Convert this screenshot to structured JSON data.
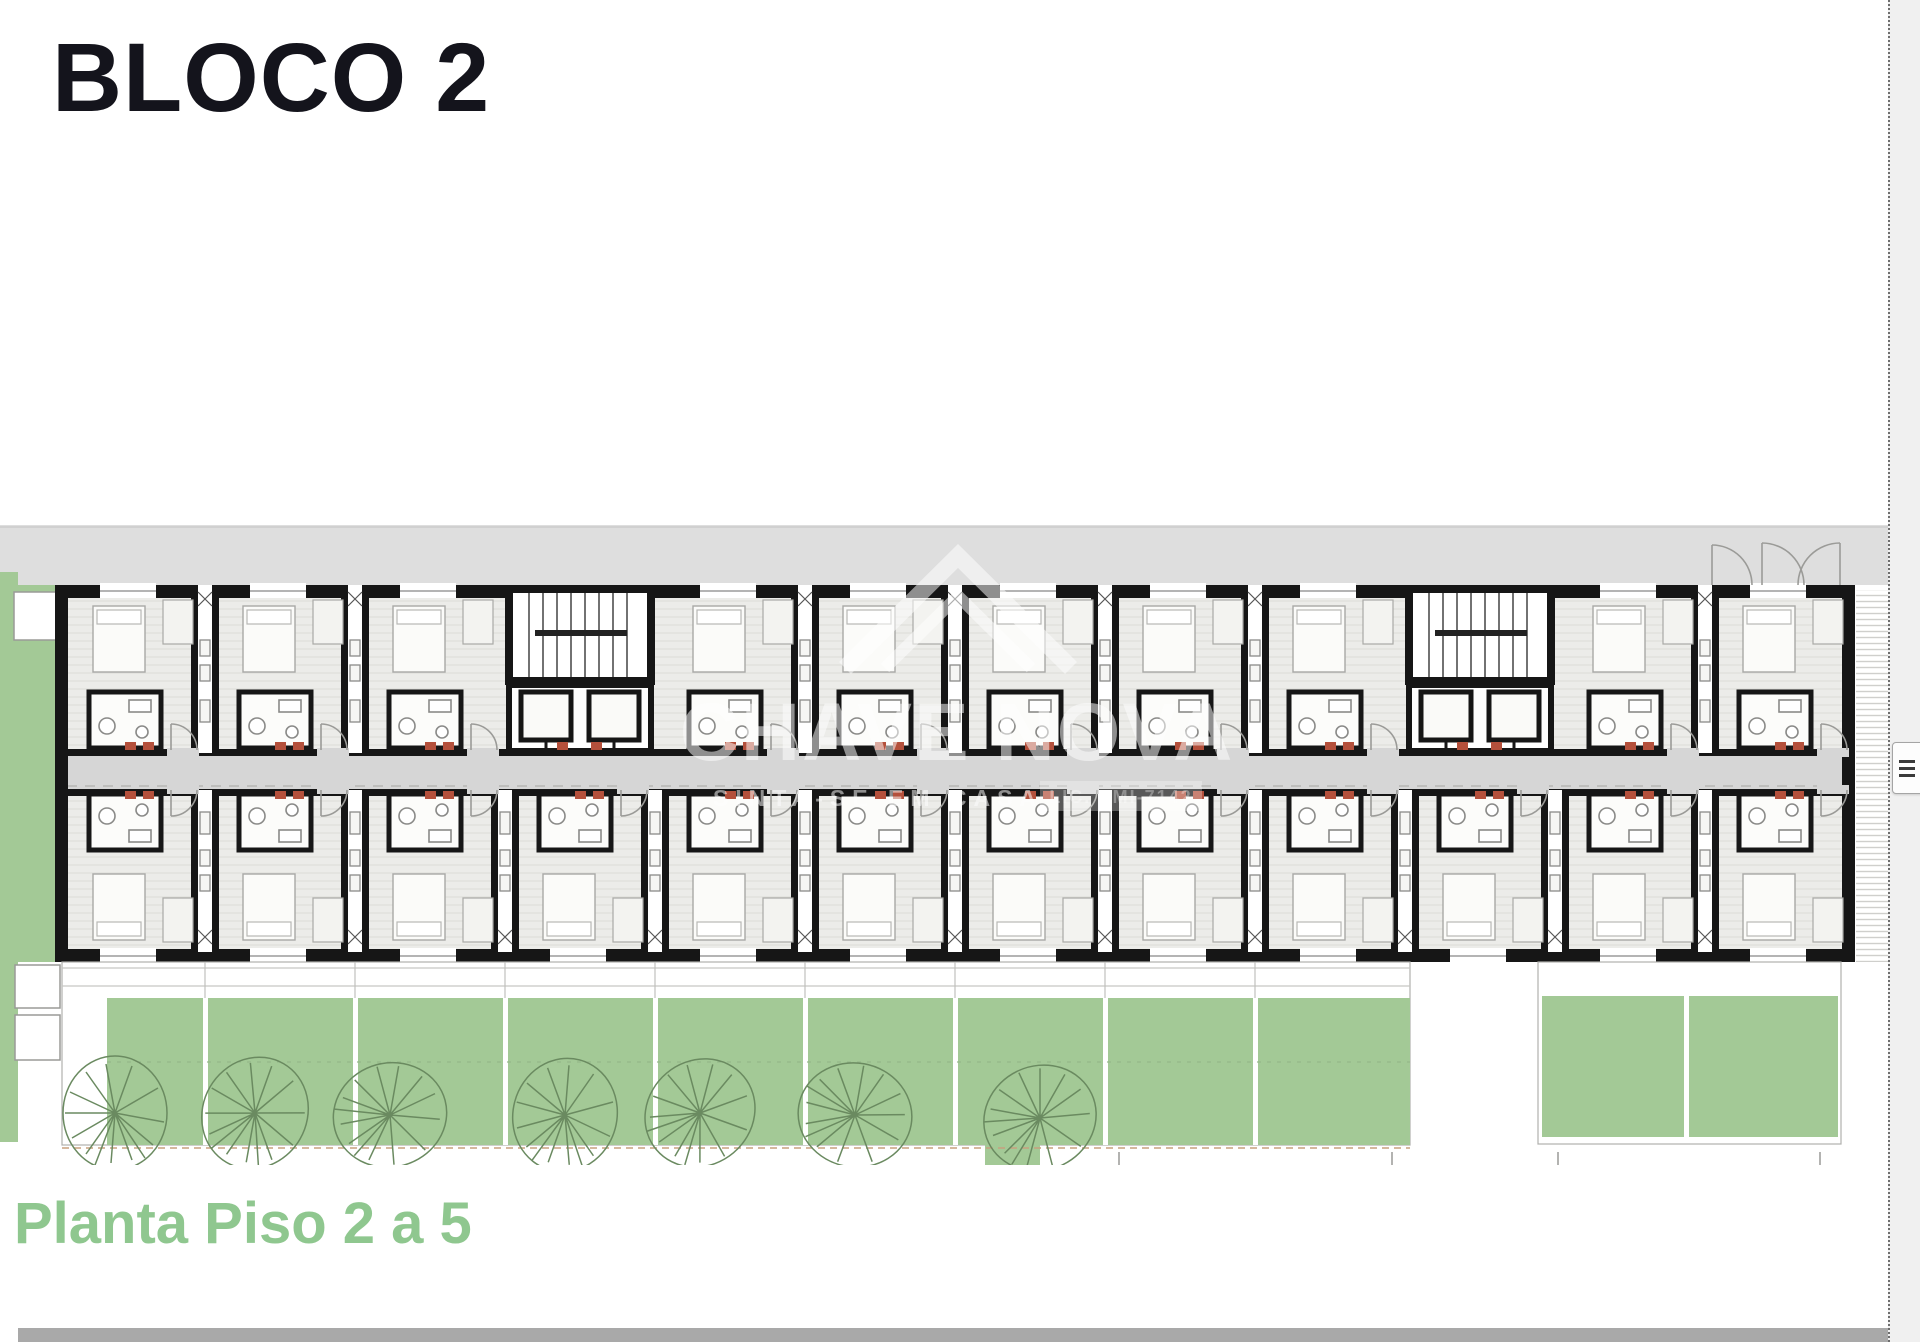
{
  "page": {
    "title": "BLOCO 2",
    "caption": "Planta Piso 2 a 5"
  },
  "watermark": {
    "brand": "CHAVE NOVA",
    "tagline": "SINTA-SE EM CASA",
    "license": "LIC. AMI-7142",
    "icon": "house-roof-icon",
    "color": "#FFFFFF"
  },
  "plan": {
    "type": "architectural-floor-plan",
    "block": "BLOCO 2",
    "floors_shown": "Piso 2 a 5",
    "stair_cores": 2,
    "apartment_units_top_row": 10,
    "apartment_units_bottom_row": 12,
    "trees": 7,
    "colors": {
      "street_gray": "#DEDEDE",
      "corridor_gray": "#D6D6D6",
      "floor_gray": "#ECECE9",
      "wall_black": "#161616",
      "garden_green": "#A3C996",
      "door_mark_red": "#B4503B",
      "title_text": "#14141C",
      "caption_green": "#8FC78F",
      "bottom_bar_gray": "#A9A9A9",
      "page_margin_gray": "#F0F0F0"
    }
  },
  "viewer": {
    "side_button": "grip-handle"
  }
}
